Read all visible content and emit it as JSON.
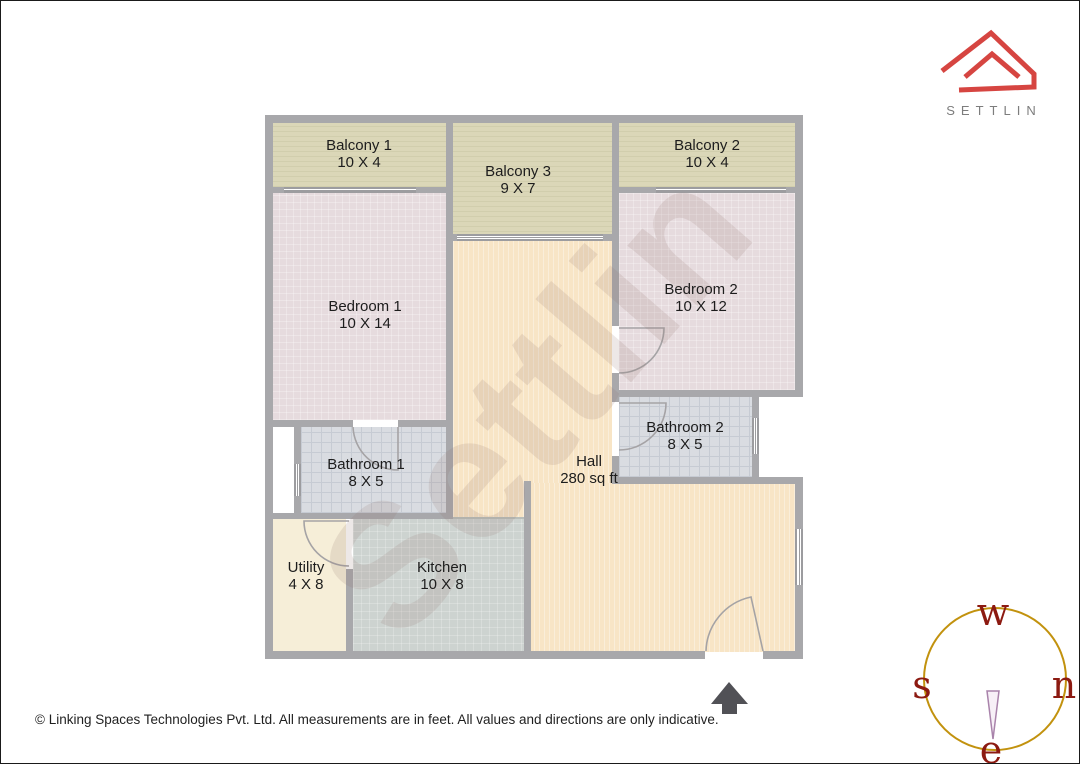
{
  "brand": {
    "name": "SETTLIN",
    "logo_color": "#d64541",
    "name_color": "#7d7d7d"
  },
  "watermark": {
    "text": "Settlin"
  },
  "rooms": [
    {
      "id": "balcony-1",
      "name": "Balcony 1",
      "dims": "10 X 4"
    },
    {
      "id": "balcony-3",
      "name": "Balcony 3",
      "dims": "9 X 7"
    },
    {
      "id": "balcony-2",
      "name": "Balcony 2",
      "dims": "10 X 4"
    },
    {
      "id": "bedroom-1",
      "name": "Bedroom 1",
      "dims": "10 X 14"
    },
    {
      "id": "bedroom-2",
      "name": "Bedroom 2",
      "dims": "10 X 12"
    },
    {
      "id": "bathroom-2",
      "name": "Bathroom 2",
      "dims": "8 X 5"
    },
    {
      "id": "bathroom-1",
      "name": "Bathroom 1",
      "dims": "8 X 5"
    },
    {
      "id": "hall",
      "name": "Hall",
      "dims": "280 sq ft"
    },
    {
      "id": "utility",
      "name": "Utility",
      "dims": "4 X 8"
    },
    {
      "id": "kitchen",
      "name": "Kitchen",
      "dims": "10 X 8"
    }
  ],
  "compass": {
    "top": "w",
    "left": "s",
    "right": "n",
    "bottom": "e",
    "ring_color": "#c2920e",
    "letter_color": "#8c1a11"
  },
  "footer": {
    "copyright": "© Linking Spaces Technologies Pvt. Ltd. All measurements are in feet. All values and directions are only indicative."
  },
  "colors": {
    "wall": "#a8a8ab",
    "balcony_floor": "#dbd7b8",
    "bedroom_floor": "#e6dbde",
    "hall_floor": "#f8e5c6",
    "bathroom_floor": "#d9dce1",
    "kitchen_floor": "#cdd3d0",
    "utility_floor": "#f6eed8",
    "entrance_arrow": "#515156"
  }
}
